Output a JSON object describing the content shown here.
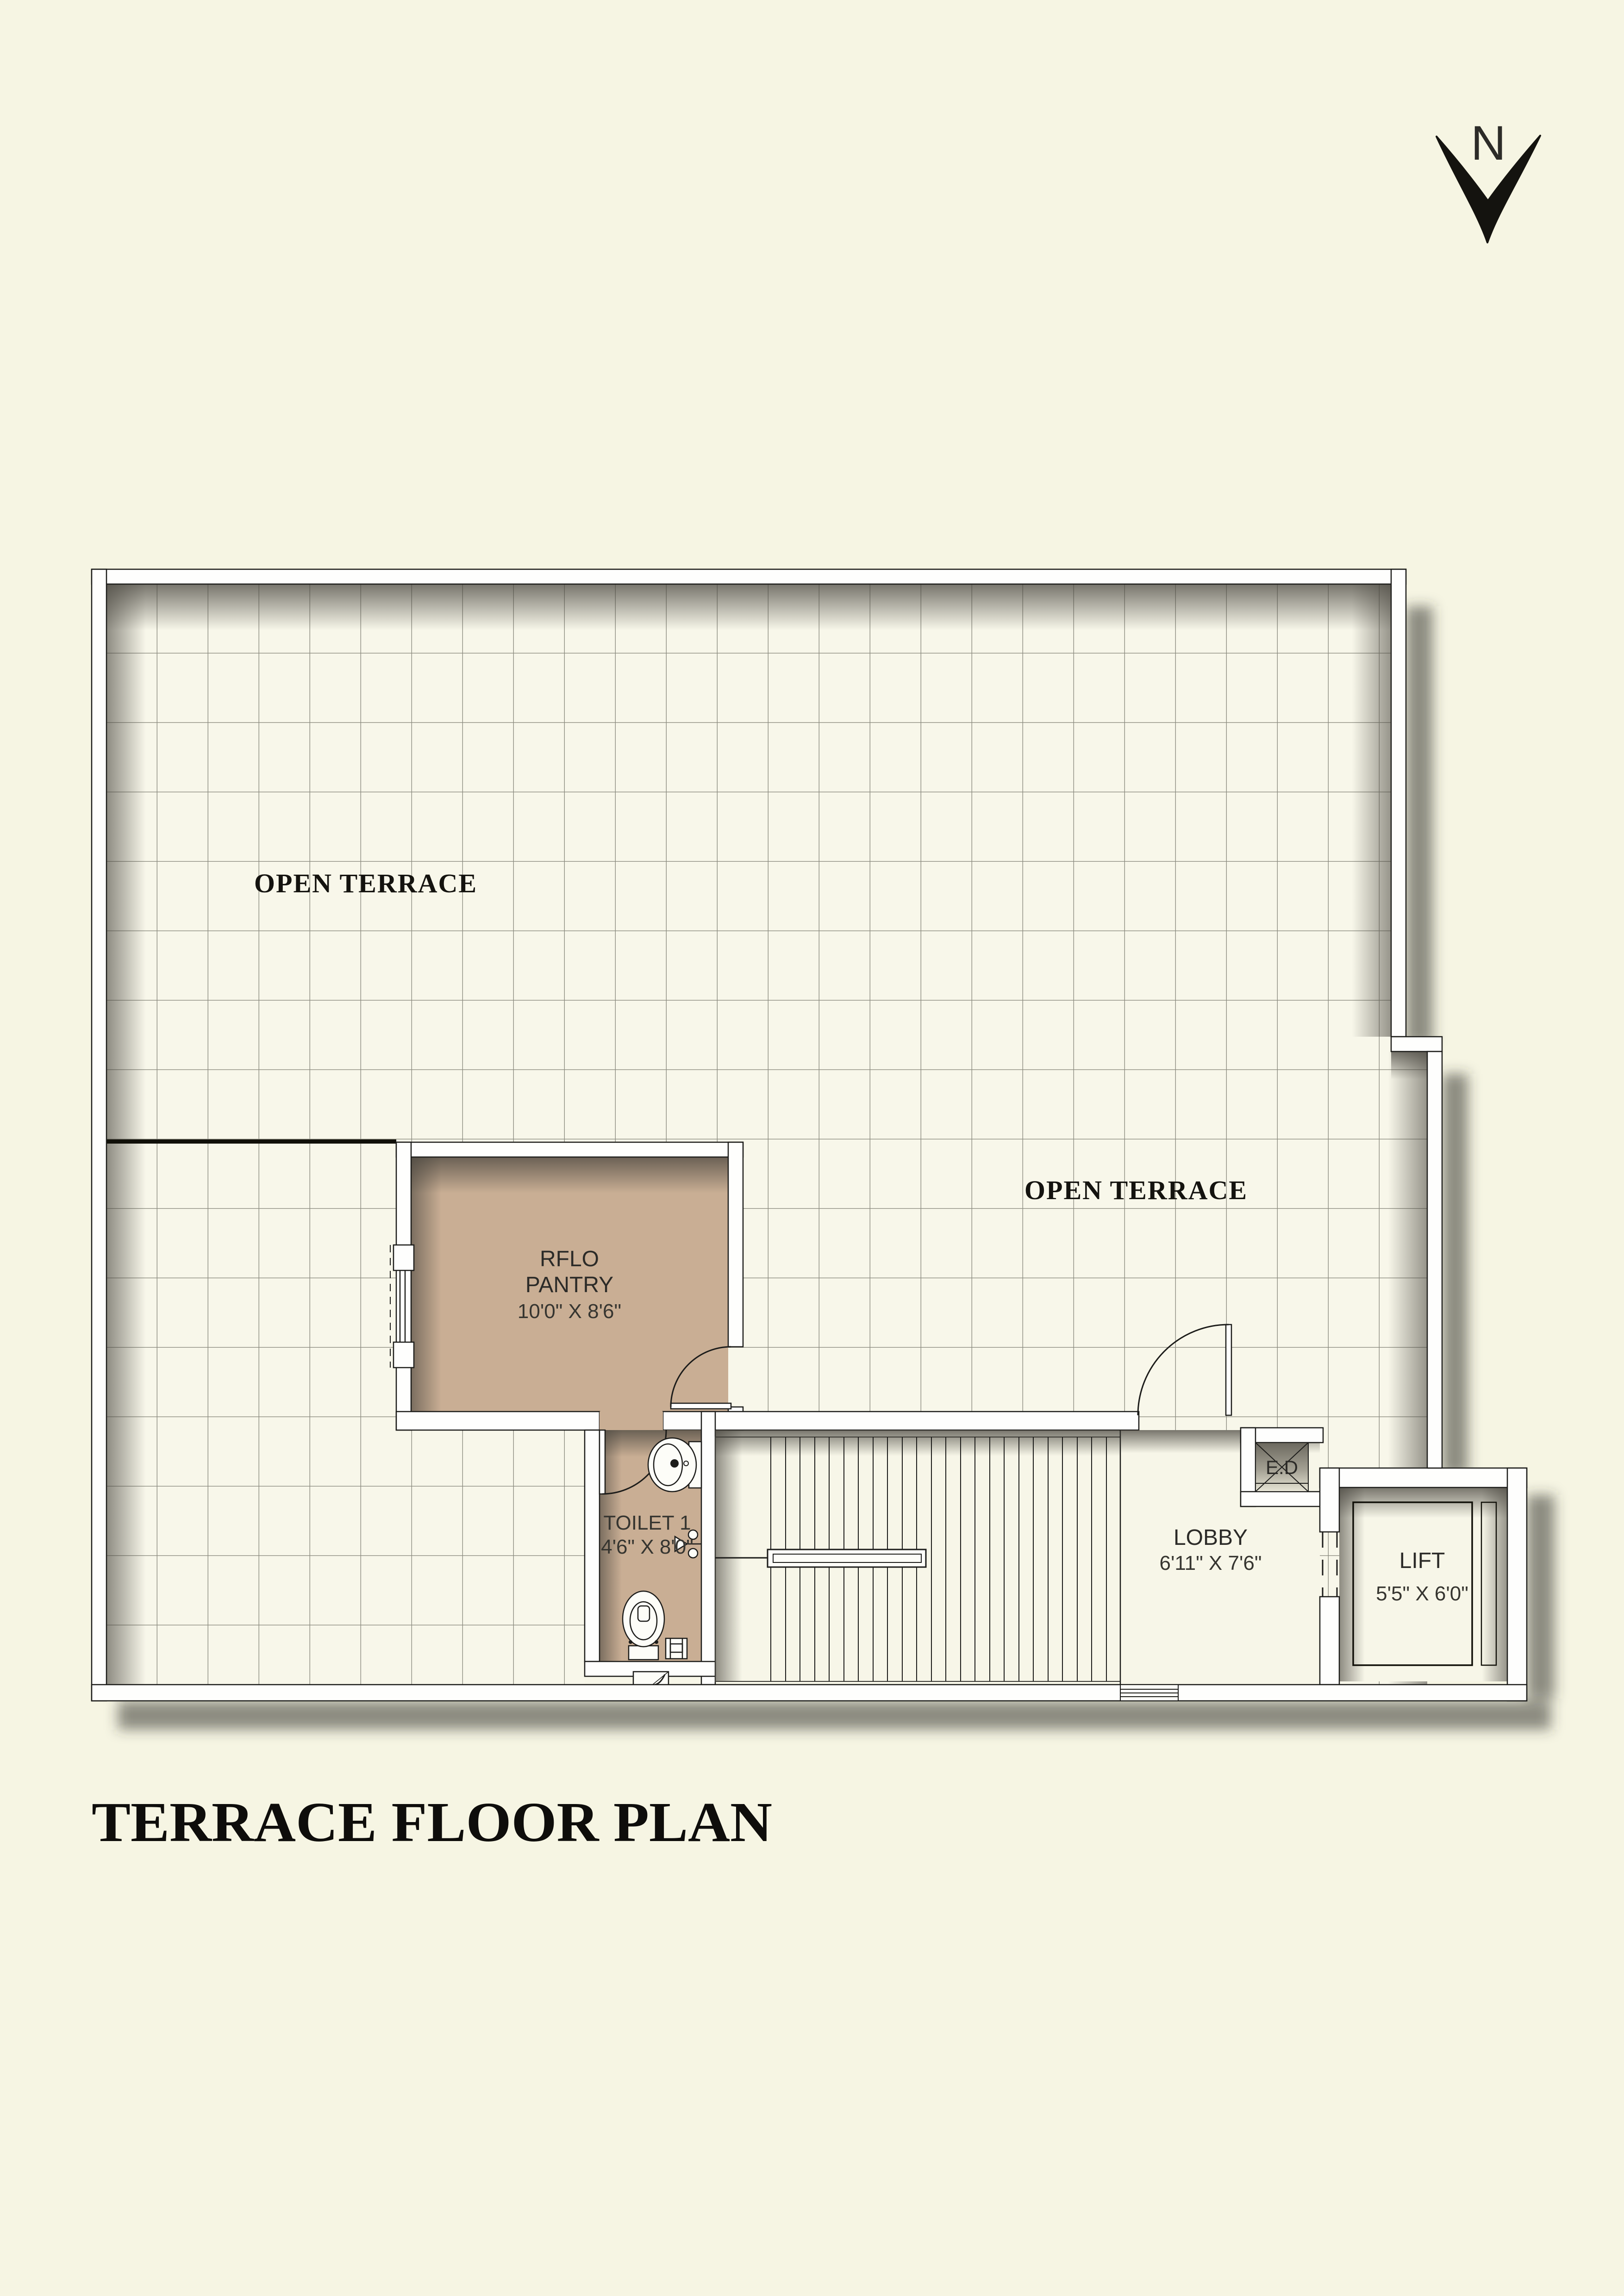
{
  "title": "TERRACE  FLOOR PLAN",
  "north": {
    "label": "N"
  },
  "labels": {
    "open_terrace_left": "OPEN TERRACE",
    "open_terrace_right": "OPEN TERRACE",
    "pantry_line1": "RFLO",
    "pantry_line2": "PANTRY",
    "pantry_dims": "10'0\" X 8'6\"",
    "toilet_name": "TOILET 1",
    "toilet_dims": "4'6\" X 8'0\"",
    "lobby_name": "LOBBY",
    "lobby_dims": "6'11\" X 7'6\"",
    "lift_name": "LIFT",
    "lift_dims": "5'5\" X 6'0\"",
    "duct_name": "E.D"
  },
  "colors": {
    "background": "#f6f5e3",
    "tile_floor": "#f8f7ea",
    "grid_line": "#8d8d81",
    "wall_fill": "#fefefd",
    "wall_line": "#1c1c1a",
    "room_fill_tan": "#c9ae94",
    "plain_floor": "#f7f6e8",
    "text_dark": "#14130f"
  }
}
